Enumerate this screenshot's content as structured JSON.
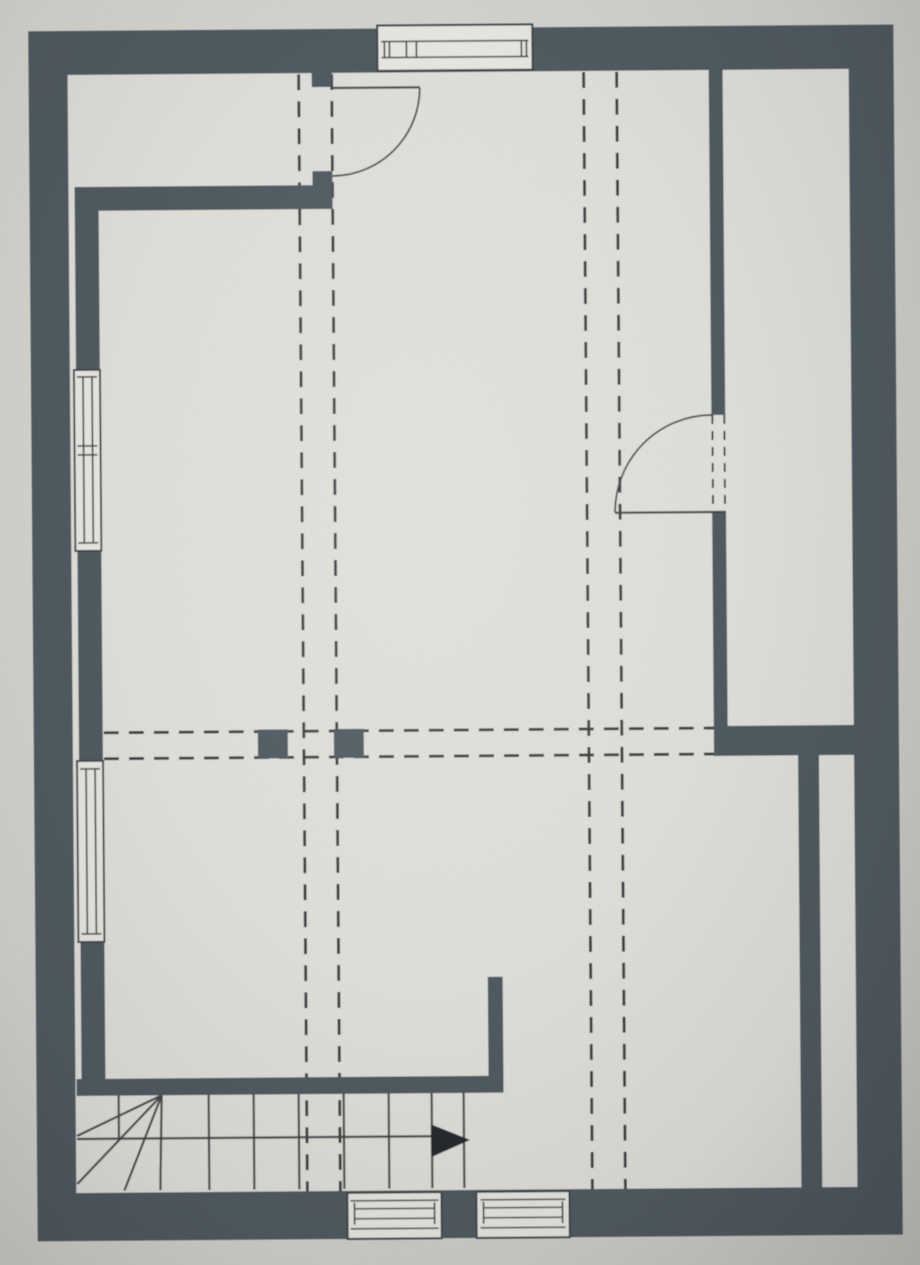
{
  "colors": {
    "paper": "#d4d3ce",
    "floor": "#e1e0db",
    "wall": "#4d585f",
    "line": "#3d4246",
    "dash": "#383d41",
    "glass": "#e9e8e3",
    "arrow": "#23272a"
  },
  "plan": {
    "canvas": {
      "w": 920,
      "h": 1265
    },
    "rotation_deg": -0.45,
    "elements": [
      {
        "t": "rect",
        "n": "plan-floor",
        "x": 33,
        "y": 28,
        "w": 865,
        "h": 1210,
        "f": "floor"
      },
      {
        "t": "line",
        "n": "roof-slope-dashed-line-left-a",
        "x1": 303,
        "y1": 73,
        "x2": 303,
        "y2": 1190,
        "s": "dash",
        "sw": 3,
        "da": "16 11"
      },
      {
        "t": "line",
        "n": "roof-slope-dashed-line-left-b",
        "x1": 336,
        "y1": 73,
        "x2": 336,
        "y2": 1190,
        "s": "dash",
        "sw": 3,
        "da": "16 11"
      },
      {
        "t": "line",
        "n": "roof-slope-dashed-line-right-a",
        "x1": 588,
        "y1": 73,
        "x2": 588,
        "y2": 1190,
        "s": "dash",
        "sw": 3,
        "da": "16 11"
      },
      {
        "t": "line",
        "n": "roof-slope-dashed-line-right-b",
        "x1": 621,
        "y1": 73,
        "x2": 621,
        "y2": 1190,
        "s": "dash",
        "sw": 3,
        "da": "16 11"
      },
      {
        "t": "line",
        "n": "beam-dashed-line-upper",
        "x1": 103,
        "y1": 730,
        "x2": 713,
        "y2": 730,
        "s": "dash",
        "sw": 3,
        "da": "15 10"
      },
      {
        "t": "line",
        "n": "beam-dashed-line-lower",
        "x1": 103,
        "y1": 756,
        "x2": 713,
        "y2": 756,
        "s": "dash",
        "sw": 3,
        "da": "15 10"
      },
      {
        "t": "line",
        "n": "stair-walk-line",
        "x1": 73,
        "y1": 1136,
        "x2": 445,
        "y2": 1136,
        "s": "line",
        "sw": 2.2
      },
      {
        "t": "line",
        "n": "stair-tread-1",
        "x1": 205,
        "y1": 1093,
        "x2": 205,
        "y2": 1188,
        "s": "line",
        "sw": 2.2
      },
      {
        "t": "line",
        "n": "stair-tread-2",
        "x1": 250,
        "y1": 1093,
        "x2": 250,
        "y2": 1188,
        "s": "line",
        "sw": 2.2
      },
      {
        "t": "line",
        "n": "stair-tread-3",
        "x1": 295,
        "y1": 1093,
        "x2": 295,
        "y2": 1188,
        "s": "line",
        "sw": 2.2
      },
      {
        "t": "line",
        "n": "stair-tread-4",
        "x1": 340,
        "y1": 1093,
        "x2": 340,
        "y2": 1188,
        "s": "line",
        "sw": 2.2
      },
      {
        "t": "line",
        "n": "stair-tread-5",
        "x1": 385,
        "y1": 1093,
        "x2": 385,
        "y2": 1188,
        "s": "line",
        "sw": 2.2
      },
      {
        "t": "line",
        "n": "stair-tread-6",
        "x1": 428,
        "y1": 1093,
        "x2": 428,
        "y2": 1188,
        "s": "line",
        "sw": 2.2
      },
      {
        "t": "line",
        "n": "stair-tread-7",
        "x1": 460,
        "y1": 1093,
        "x2": 460,
        "y2": 1188,
        "s": "line",
        "sw": 2.2
      },
      {
        "t": "line",
        "n": "stair-tread-half",
        "x1": 115,
        "y1": 1093,
        "x2": 115,
        "y2": 1136,
        "s": "line",
        "sw": 2.2
      },
      {
        "t": "line",
        "n": "stair-winder-1",
        "x1": 158,
        "y1": 1093,
        "x2": 73,
        "y2": 1133,
        "s": "line",
        "sw": 2.2
      },
      {
        "t": "line",
        "n": "stair-winder-2",
        "x1": 158,
        "y1": 1093,
        "x2": 73,
        "y2": 1181,
        "s": "line",
        "sw": 2.2
      },
      {
        "t": "line",
        "n": "stair-winder-3",
        "x1": 158,
        "y1": 1093,
        "x2": 120,
        "y2": 1188,
        "s": "line",
        "sw": 2.2
      },
      {
        "t": "line",
        "n": "stair-winder-4",
        "x1": 158,
        "y1": 1093,
        "x2": 156,
        "y2": 1188,
        "s": "line",
        "sw": 2.2
      },
      {
        "t": "rect",
        "n": "outer-wall-top",
        "x": 33,
        "y": 28,
        "w": 865,
        "h": 44,
        "f": "wall"
      },
      {
        "t": "rect",
        "n": "outer-wall-left",
        "x": 33,
        "y": 28,
        "w": 39,
        "h": 1210,
        "f": "wall"
      },
      {
        "t": "rect",
        "n": "outer-wall-right",
        "x": 853,
        "y": 28,
        "w": 45,
        "h": 1210,
        "f": "wall"
      },
      {
        "t": "rect",
        "n": "outer-wall-bottom",
        "x": 33,
        "y": 1190,
        "w": 865,
        "h": 48,
        "f": "wall"
      },
      {
        "t": "rect",
        "n": "knee-wall-top-left",
        "x": 78,
        "y": 184,
        "w": 258,
        "h": 24,
        "f": "wall"
      },
      {
        "t": "rect",
        "n": "door-top-wall-stub",
        "x": 316,
        "y": 70,
        "w": 20,
        "h": 16,
        "f": "wall"
      },
      {
        "t": "rect",
        "n": "door-top-jamb-block",
        "x": 316,
        "y": 170,
        "w": 20,
        "h": 38,
        "f": "wall"
      },
      {
        "t": "rect",
        "n": "inner-wall-leaf-left",
        "x": 78,
        "y": 208,
        "w": 24,
        "h": 868,
        "f": "wall"
      },
      {
        "t": "rect",
        "n": "partition-wall-right-upper",
        "x": 713,
        "y": 70,
        "w": 14,
        "h": 347,
        "f": "wall"
      },
      {
        "t": "rect",
        "n": "partition-wall-right-lower",
        "x": 713,
        "y": 514,
        "w": 14,
        "h": 216,
        "f": "wall"
      },
      {
        "t": "rect",
        "n": "wall-right-horizontal",
        "x": 713,
        "y": 728,
        "w": 140,
        "h": 30,
        "f": "wall"
      },
      {
        "t": "rect",
        "n": "inner-wall-leaf-right",
        "x": 797,
        "y": 758,
        "w": 21,
        "h": 432,
        "f": "wall"
      },
      {
        "t": "rect",
        "n": "wall-landing-vertical",
        "x": 485,
        "y": 977,
        "w": 15,
        "h": 116,
        "f": "wall"
      },
      {
        "t": "rect",
        "n": "wall-above-stair",
        "x": 73,
        "y": 1076,
        "w": 427,
        "h": 17,
        "f": "wall"
      },
      {
        "t": "rect",
        "n": "post-left",
        "x": 257,
        "y": 728,
        "w": 30,
        "h": 29,
        "f": "wall"
      },
      {
        "t": "rect",
        "n": "post-right",
        "x": 333,
        "y": 728,
        "w": 30,
        "h": 29,
        "f": "wall"
      },
      {
        "t": "rect",
        "n": "window-top-box",
        "x": 382,
        "y": 25,
        "w": 155,
        "h": 46,
        "f": "glass",
        "s": "line",
        "sw": 2
      },
      {
        "t": "line",
        "n": "window-top-glass-line-a",
        "x1": 386,
        "y1": 41,
        "x2": 533,
        "y2": 41,
        "s": "line",
        "sw": 1.6
      },
      {
        "t": "line",
        "n": "window-top-glass-line-b",
        "x1": 386,
        "y1": 57,
        "x2": 533,
        "y2": 57,
        "s": "line",
        "sw": 1.6
      },
      {
        "t": "line",
        "n": "window-top-cap-left-a",
        "x1": 389,
        "y1": 41,
        "x2": 389,
        "y2": 57,
        "s": "line",
        "sw": 1.6
      },
      {
        "t": "line",
        "n": "window-top-cap-left-b",
        "x1": 394,
        "y1": 41,
        "x2": 394,
        "y2": 57,
        "s": "line",
        "sw": 1.6
      },
      {
        "t": "line",
        "n": "window-top-mullion-a",
        "x1": 411,
        "y1": 41,
        "x2": 411,
        "y2": 57,
        "s": "line",
        "sw": 1.6
      },
      {
        "t": "line",
        "n": "window-top-mullion-b",
        "x1": 421,
        "y1": 41,
        "x2": 421,
        "y2": 57,
        "s": "line",
        "sw": 1.6
      },
      {
        "t": "line",
        "n": "window-top-cap-right-a",
        "x1": 526,
        "y1": 41,
        "x2": 526,
        "y2": 57,
        "s": "line",
        "sw": 1.6
      },
      {
        "t": "line",
        "n": "window-top-cap-right-b",
        "x1": 531,
        "y1": 41,
        "x2": 531,
        "y2": 57,
        "s": "line",
        "sw": 1.6
      },
      {
        "t": "line",
        "n": "window-top-sill-line",
        "x1": 382,
        "y1": 70,
        "x2": 537,
        "y2": 70,
        "s": "line",
        "sw": 1.6
      },
      {
        "t": "rect",
        "n": "window-left-upper-box",
        "x": 76,
        "y": 367,
        "w": 26,
        "h": 181,
        "f": "glass",
        "s": "line",
        "sw": 2
      },
      {
        "t": "line",
        "n": "window-left-upper-glass-a",
        "x1": 85,
        "y1": 374,
        "x2": 85,
        "y2": 540,
        "s": "line",
        "sw": 1.6
      },
      {
        "t": "line",
        "n": "window-left-upper-glass-b",
        "x1": 94,
        "y1": 374,
        "x2": 94,
        "y2": 540,
        "s": "line",
        "sw": 1.6
      },
      {
        "t": "line",
        "n": "window-left-upper-cap-top",
        "x1": 79,
        "y1": 374,
        "x2": 99,
        "y2": 374,
        "s": "line",
        "sw": 1.6
      },
      {
        "t": "line",
        "n": "window-left-upper-mullion-a",
        "x1": 79,
        "y1": 443,
        "x2": 99,
        "y2": 443,
        "s": "line",
        "sw": 1.6
      },
      {
        "t": "line",
        "n": "window-left-upper-mullion-b",
        "x1": 79,
        "y1": 452,
        "x2": 99,
        "y2": 452,
        "s": "line",
        "sw": 1.6
      },
      {
        "t": "line",
        "n": "window-left-upper-cap-bottom",
        "x1": 79,
        "y1": 540,
        "x2": 99,
        "y2": 540,
        "s": "line",
        "sw": 1.6
      },
      {
        "t": "rect",
        "n": "window-left-lower-box",
        "x": 76,
        "y": 758,
        "w": 26,
        "h": 181,
        "f": "glass",
        "s": "line",
        "sw": 2
      },
      {
        "t": "line",
        "n": "window-left-lower-glass-a",
        "x1": 85,
        "y1": 766,
        "x2": 85,
        "y2": 931,
        "s": "line",
        "sw": 1.6
      },
      {
        "t": "line",
        "n": "window-left-lower-glass-b",
        "x1": 94,
        "y1": 766,
        "x2": 94,
        "y2": 931,
        "s": "line",
        "sw": 1.6
      },
      {
        "t": "line",
        "n": "window-left-lower-cap-top",
        "x1": 79,
        "y1": 766,
        "x2": 99,
        "y2": 766,
        "s": "line",
        "sw": 1.6
      },
      {
        "t": "line",
        "n": "window-left-lower-cap-bottom",
        "x1": 79,
        "y1": 931,
        "x2": 99,
        "y2": 931,
        "s": "line",
        "sw": 1.6
      },
      {
        "t": "rect",
        "n": "window-bottom-left-box",
        "x": 343,
        "y": 1192,
        "w": 94,
        "h": 46,
        "f": "glass",
        "s": "line",
        "sw": 2
      },
      {
        "t": "line",
        "n": "window-bottom-left-frame-top",
        "x1": 346,
        "y1": 1200,
        "x2": 434,
        "y2": 1200,
        "s": "line",
        "sw": 1.4
      },
      {
        "t": "line",
        "n": "window-bottom-left-frame-bottom",
        "x1": 346,
        "y1": 1228,
        "x2": 434,
        "y2": 1228,
        "s": "line",
        "sw": 1.4
      },
      {
        "t": "line",
        "n": "window-bottom-left-glass-a",
        "x1": 350,
        "y1": 1208,
        "x2": 430,
        "y2": 1208,
        "s": "line",
        "sw": 1.6
      },
      {
        "t": "line",
        "n": "window-bottom-left-glass-b",
        "x1": 350,
        "y1": 1218,
        "x2": 430,
        "y2": 1218,
        "s": "line",
        "sw": 1.6
      },
      {
        "t": "line",
        "n": "window-bottom-left-cap-a",
        "x1": 350,
        "y1": 1202,
        "x2": 350,
        "y2": 1224,
        "s": "line",
        "sw": 1.6
      },
      {
        "t": "line",
        "n": "window-bottom-left-cap-b",
        "x1": 430,
        "y1": 1202,
        "x2": 430,
        "y2": 1224,
        "s": "line",
        "sw": 1.6
      },
      {
        "t": "rect",
        "n": "window-bottom-right-box",
        "x": 472,
        "y": 1192,
        "w": 93,
        "h": 46,
        "f": "glass",
        "s": "line",
        "sw": 2
      },
      {
        "t": "line",
        "n": "window-bottom-right-frame-top",
        "x1": 476,
        "y1": 1200,
        "x2": 561,
        "y2": 1200,
        "s": "line",
        "sw": 1.4
      },
      {
        "t": "line",
        "n": "window-bottom-right-frame-bottom",
        "x1": 476,
        "y1": 1228,
        "x2": 561,
        "y2": 1228,
        "s": "line",
        "sw": 1.4
      },
      {
        "t": "line",
        "n": "window-bottom-right-glass-a",
        "x1": 479,
        "y1": 1208,
        "x2": 558,
        "y2": 1208,
        "s": "line",
        "sw": 1.6
      },
      {
        "t": "line",
        "n": "window-bottom-right-glass-b",
        "x1": 479,
        "y1": 1218,
        "x2": 558,
        "y2": 1218,
        "s": "line",
        "sw": 1.6
      },
      {
        "t": "line",
        "n": "window-bottom-right-cap-a",
        "x1": 479,
        "y1": 1202,
        "x2": 479,
        "y2": 1224,
        "s": "line",
        "sw": 1.6
      },
      {
        "t": "line",
        "n": "window-bottom-right-cap-b",
        "x1": 558,
        "y1": 1202,
        "x2": 558,
        "y2": 1224,
        "s": "line",
        "sw": 1.6
      },
      {
        "t": "line",
        "n": "door-top-leaf",
        "x1": 336,
        "y1": 87,
        "x2": 424,
        "y2": 87,
        "s": "line",
        "sw": 2.2
      },
      {
        "t": "path",
        "n": "door-top-swing-arc",
        "d": "M424,87 A88,88 0 0 1 336,175",
        "s": "line",
        "sw": 1.8
      },
      {
        "t": "line",
        "n": "door-right-leaf",
        "x1": 616,
        "y1": 514,
        "x2": 727,
        "y2": 514,
        "s": "line",
        "sw": 2.2
      },
      {
        "t": "path",
        "n": "door-right-swing-arc",
        "d": "M616,514 A97,97 0 0 1 713,417",
        "s": "line",
        "sw": 1.8
      },
      {
        "t": "line",
        "n": "door-right-jamb-dash-a",
        "x1": 714,
        "y1": 417,
        "x2": 714,
        "y2": 510,
        "s": "dash",
        "sw": 2,
        "da": "9 7"
      },
      {
        "t": "line",
        "n": "door-right-jamb-dash-b",
        "x1": 726,
        "y1": 417,
        "x2": 726,
        "y2": 510,
        "s": "dash",
        "sw": 2,
        "da": "9 7"
      },
      {
        "t": "poly",
        "n": "stair-direction-arrow",
        "p": "427,1124 466,1140 427,1157",
        "f": "arrow"
      }
    ]
  }
}
